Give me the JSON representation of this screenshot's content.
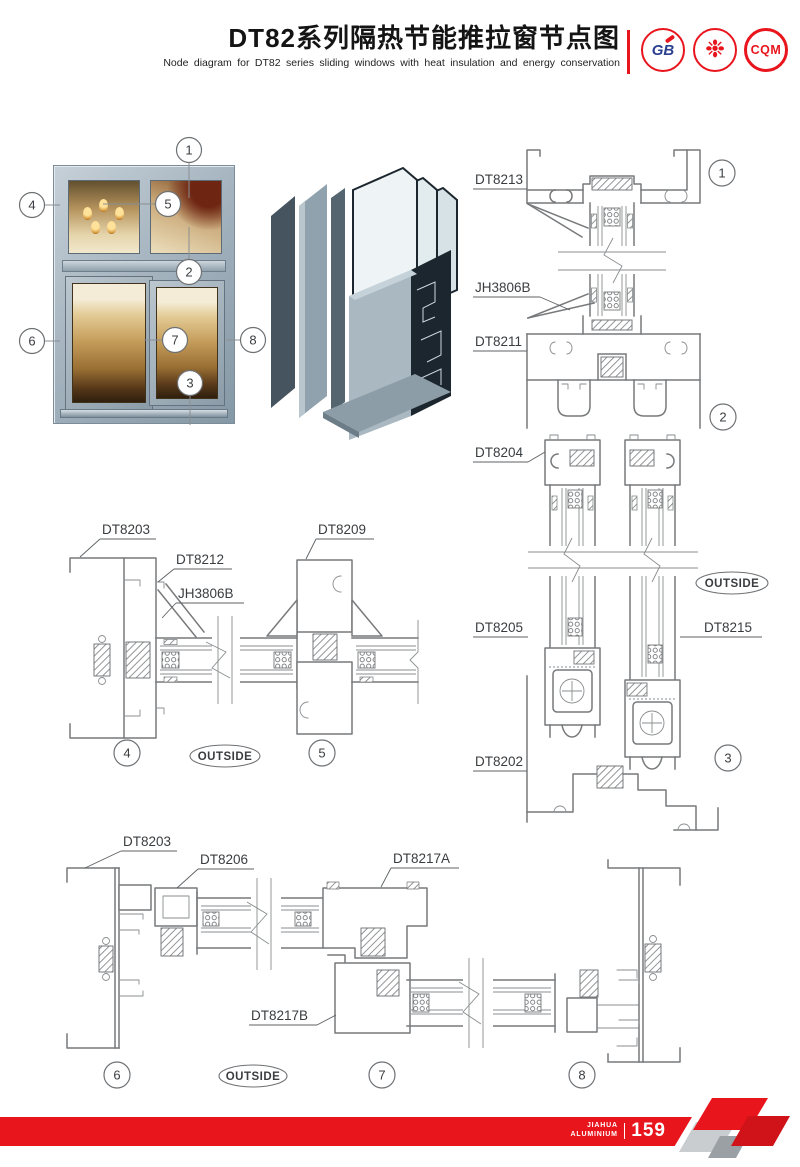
{
  "header": {
    "title_cn": "DT82系列隔热节能推拉窗节点图",
    "subtitle_en": "Node diagram for DT82 series sliding windows with heat insulation and energy conservation",
    "logo_gb": "GB",
    "logo_seal": "❉",
    "logo_cqm": "CQM"
  },
  "photo": {
    "callouts": {
      "n1": "1",
      "n2": "2",
      "n3": "3",
      "n4": "4",
      "n5": "5",
      "n6": "6",
      "n7": "7",
      "n8": "8"
    }
  },
  "right_section": {
    "dt8213": "DT8213",
    "jh3806b": "JH3806B",
    "dt8211": "DT8211",
    "dt8204": "DT8204",
    "dt8205": "DT8205",
    "dt8215": "DT8215",
    "dt8202": "DT8202",
    "outside": "OUTSIDE",
    "c1": "1",
    "c2": "2",
    "c3": "3"
  },
  "middle_section": {
    "dt8203": "DT8203",
    "dt8212": "DT8212",
    "jh3806b": "JH3806B",
    "dt8209": "DT8209",
    "outside": "OUTSIDE",
    "c4": "4",
    "c5": "5"
  },
  "bottom_section": {
    "dt8203": "DT8203",
    "dt8206": "DT8206",
    "dt8217a": "DT8217A",
    "dt8217b": "DT8217B",
    "outside": "OUTSIDE",
    "c6": "6",
    "c7": "7",
    "c8": "8"
  },
  "footer": {
    "brand_top": "JIAHUA",
    "brand_bottom": "ALUMINIUM",
    "page_number": "159"
  },
  "colors": {
    "accent_red": "#e8151d",
    "cad_line": "#77797b",
    "label_text": "#3a3d40"
  }
}
